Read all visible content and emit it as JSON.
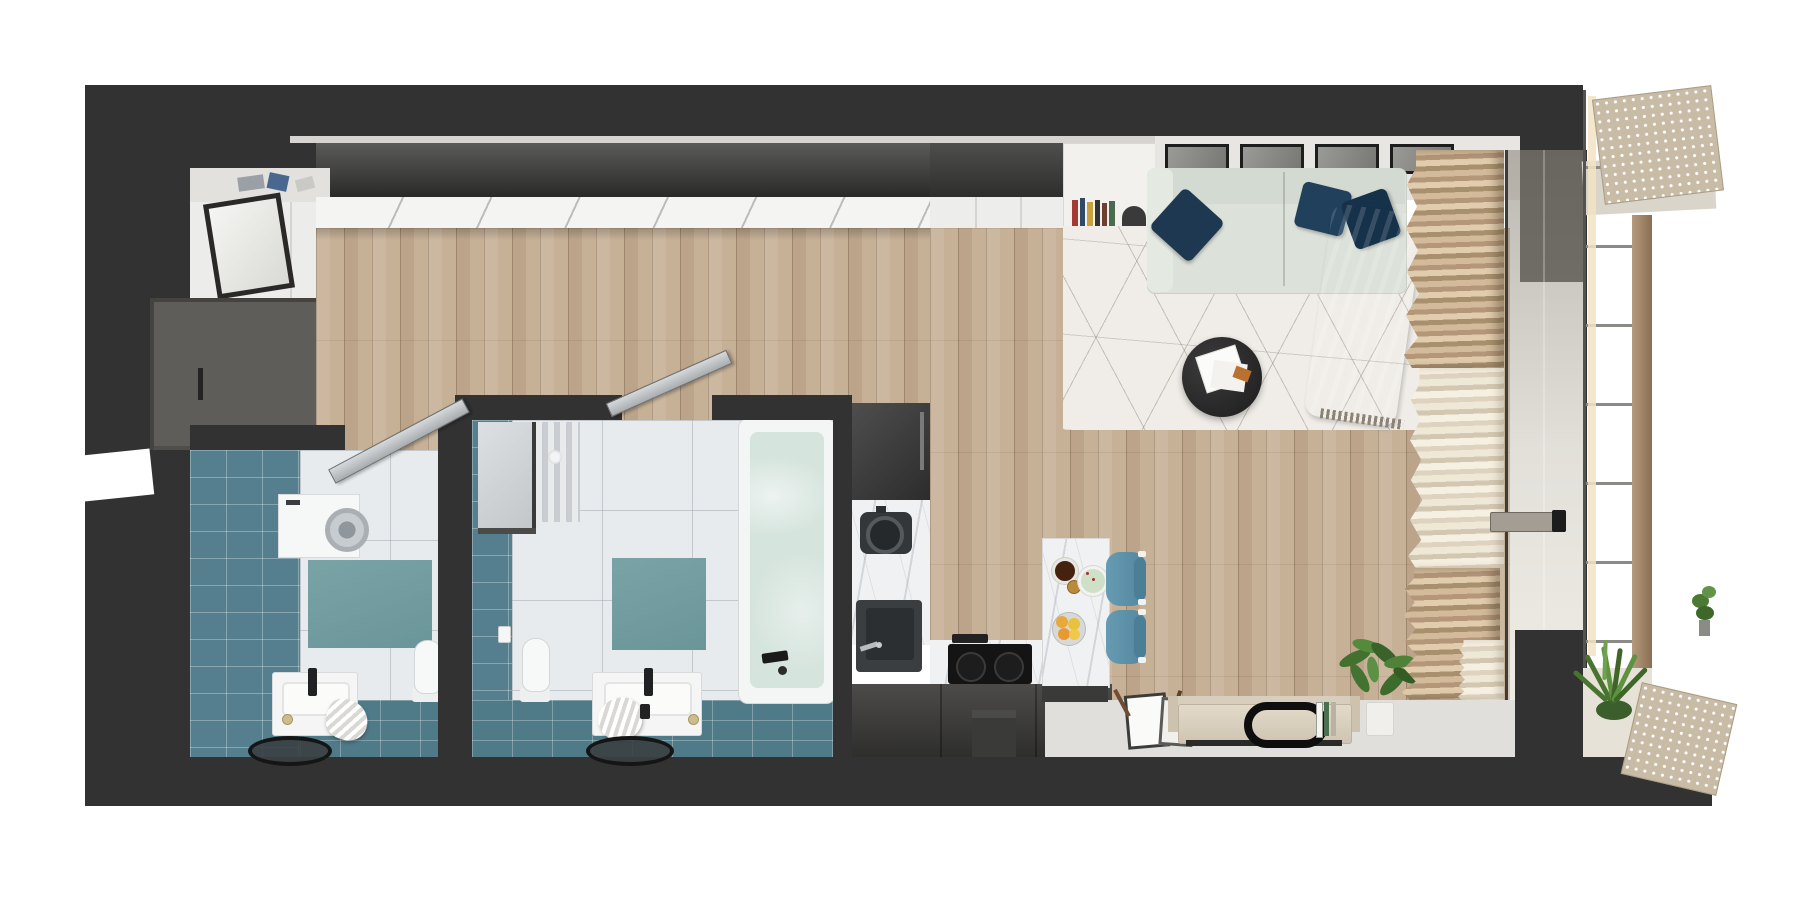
{
  "scene": {
    "kind": "apartment-floorplan-3d-render",
    "view": "top-down cutaway",
    "background": "#ffffff"
  },
  "palette": {
    "wall": "#323232",
    "wood_floor": "#c6b096",
    "blue_tile": "#557f8e",
    "white_tile": "#e8ebed",
    "marble": "#f0f1f3",
    "teal_mat": "#7aa3a6",
    "sofa": "#dce2da",
    "navy_pillow": "#1d3850",
    "chair_blue": "#5f93aa",
    "curtain_tan": "#c3a587",
    "curtain_cream": "#efe8d7",
    "rug": "#f0ede8",
    "plant_green": "#4f8238"
  },
  "rooms": [
    {
      "name": "entry-hall",
      "items": [
        "entry-door-niche",
        "wardrobe",
        "leaning-mirror",
        "shelf-clutter"
      ]
    },
    {
      "name": "bathroom-1",
      "items": [
        "door",
        "washing-machine",
        "teal-bath-mat",
        "toilet",
        "vanity-sink",
        "black-faucet",
        "towel",
        "round-floor-tray"
      ]
    },
    {
      "name": "bathroom-2",
      "items": [
        "door",
        "mirror-cabinet",
        "towel-rail",
        "teal-bath-mat",
        "toilet",
        "toilet-paper-holder",
        "vanity-sink",
        "black-faucet",
        "towel",
        "round-floor-tray",
        "bathtub"
      ]
    },
    {
      "name": "kitchen",
      "items": [
        "tall-fridge-cabinet",
        "marble-counter",
        "round-cooker",
        "dark-sink",
        "cooktop",
        "base-cabinets",
        "stool",
        "marble-island",
        "bar-chair-1",
        "bar-chair-2",
        "coffee-cup",
        "muffin",
        "dessert-bowl",
        "fruit-bowl"
      ]
    },
    {
      "name": "living-room",
      "items": [
        "ceiling-light-strip",
        "media-cabinet",
        "bookshelf",
        "picture-frames",
        "sofa",
        "navy-pillows",
        "throw-blanket",
        "geometric-rug",
        "round-coffee-table",
        "magazines",
        "sideboard-bench",
        "leaning-frames",
        "potted-plant",
        "curtains",
        "sliding-glass-door"
      ]
    },
    {
      "name": "balcony",
      "items": [
        "glass-facade",
        "timber-rail",
        "perforated-screen-top",
        "perforated-screen-bottom",
        "spiky-plant",
        "small-plant"
      ]
    }
  ]
}
